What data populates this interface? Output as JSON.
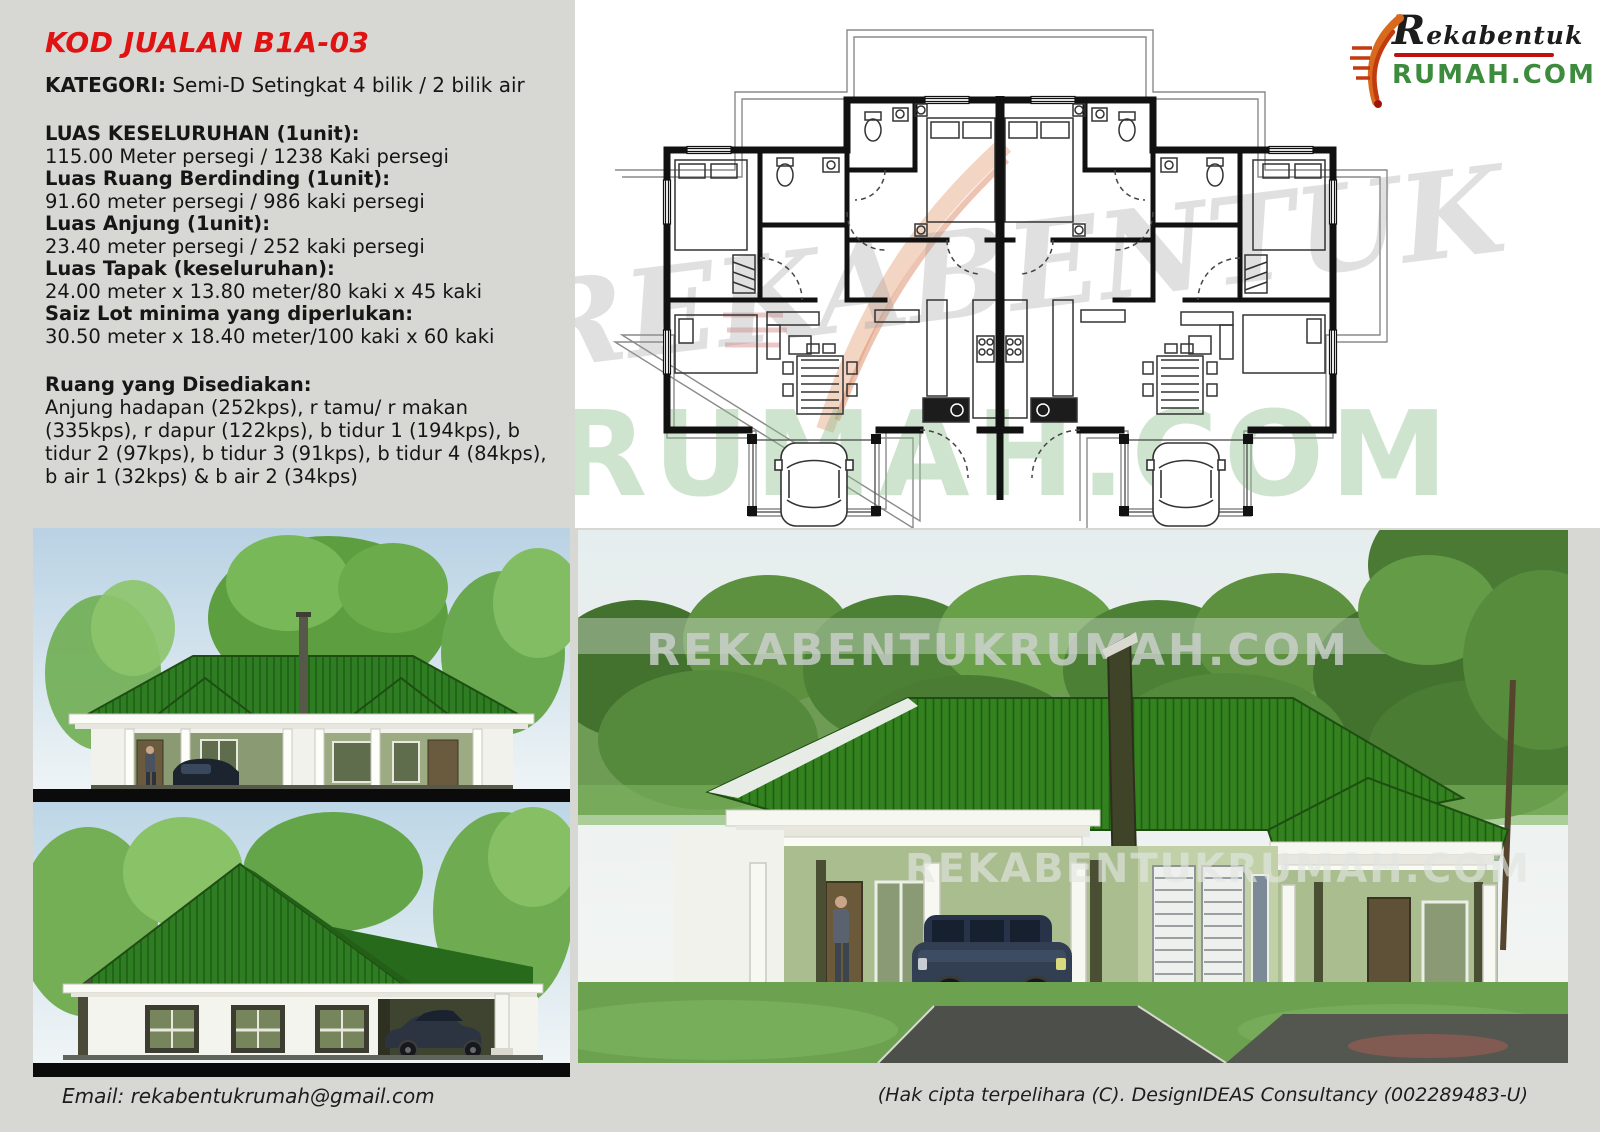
{
  "info": {
    "code_title": "KOD JUALAN B1A-03",
    "category_label": "KATEGORI:",
    "category_value": " Semi-D Setingkat 4 bilik / 2 bilik air",
    "specs": [
      {
        "label": "LUAS KESELURUHAN (1unit):",
        "value": "115.00 Meter persegi / 1238 Kaki persegi"
      },
      {
        "label": "Luas Ruang Berdinding (1unit):",
        "value": "91.60 meter persegi / 986 kaki persegi"
      },
      {
        "label": "Luas Anjung (1unit):",
        "value": "23.40 meter persegi / 252 kaki persegi"
      },
      {
        "label": "Luas Tapak (keseluruhan):",
        "value": "24.00 meter x 13.80 meter/80 kaki x 45 kaki"
      },
      {
        "label": "Saiz Lot minima yang diperlukan:",
        "value": "30.50 meter x 18.40 meter/100 kaki x 60 kaki"
      }
    ],
    "rooms_label": "Ruang yang Disediakan:",
    "rooms_text": "Anjung hadapan (252kps), r tamu/ r makan (335kps), r dapur (122kps), b tidur 1 (194kps), b tidur 2 (97kps), b tidur 3 (91kps), b tidur 4 (84kps), b air 1 (32kps) & b air 2 (34kps)"
  },
  "logo": {
    "line1": "Rekabentuk",
    "line2": "RUMAH.COM"
  },
  "plan": {
    "watermark_top": "REKABENTUK",
    "watermark_bottom": "RUMAH.COM"
  },
  "renders": {
    "watermark": "REKABENTUKRUMAH.COM"
  },
  "footer": {
    "email": "Email: rekabentukrumah@gmail.com",
    "copyright": "(Hak cipta terpelihara (C). DesignIDEAS Consultancy (002289483-U)"
  },
  "colors": {
    "accent_red": "#e01212",
    "logo_green": "#3d8b3d",
    "roof_green": "#2f7d22",
    "page_gray": "#d7d7d3"
  }
}
